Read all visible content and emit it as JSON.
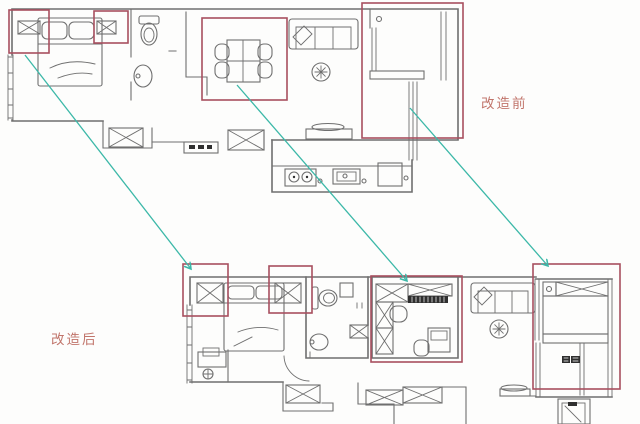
{
  "labels": {
    "before": "改造前",
    "after": "改造后"
  },
  "colors": {
    "background": "#fdfdfc",
    "plan_line": "#6f6f6f",
    "dark_fill": "#2f2f2f",
    "highlight_box": "#a84f5f",
    "arrow": "#3cb8a8",
    "label_text": "#c1756b"
  },
  "icons": {
    "wardrobe": "x-box",
    "ceiling_fan": "asterisk-in-circle",
    "stool": "circle-with-cross",
    "deck_floor": "basket-weave-hatch"
  },
  "annotations": {
    "highlight_boxes": [
      {
        "plan": "before",
        "name": "wardrobe-left",
        "x": 9,
        "y": 10,
        "w": 40,
        "h": 43
      },
      {
        "plan": "before",
        "name": "wardrobe-right",
        "x": 94,
        "y": 11,
        "w": 34,
        "h": 32
      },
      {
        "plan": "before",
        "name": "dining-area",
        "x": 202,
        "y": 18,
        "w": 85,
        "h": 82
      },
      {
        "plan": "before",
        "name": "balcony-room",
        "x": 362,
        "y": 3,
        "w": 101,
        "h": 135
      },
      {
        "plan": "after",
        "name": "wardrobe-left",
        "x": 183,
        "y": 264,
        "w": 45,
        "h": 52
      },
      {
        "plan": "after",
        "name": "wardrobe-right",
        "x": 269,
        "y": 266,
        "w": 43,
        "h": 47
      },
      {
        "plan": "after",
        "name": "study-room",
        "x": 371,
        "y": 276,
        "w": 91,
        "h": 86
      },
      {
        "plan": "after",
        "name": "balcony",
        "x": 533,
        "y": 264,
        "w": 87,
        "h": 125
      }
    ],
    "arrows": [
      {
        "x1": 25,
        "y1": 55,
        "x2": 191,
        "y2": 269
      },
      {
        "x1": 237,
        "y1": 85,
        "x2": 407,
        "y2": 281
      },
      {
        "x1": 410,
        "y1": 108,
        "x2": 548,
        "y2": 266
      }
    ]
  }
}
